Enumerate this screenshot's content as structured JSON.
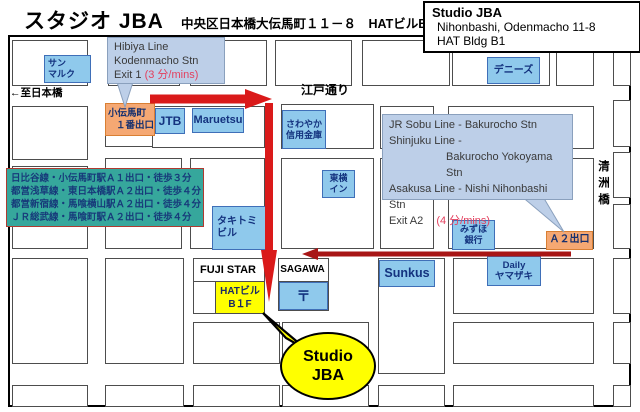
{
  "header": {
    "title": "スタジオ JBA",
    "address": "中央区日本橋大伝馬町１１－８　HATビルB１",
    "info_box": {
      "line1": "Studio JBA",
      "line2": "Nihonbashi, Odenmacho 11-8",
      "line3": "HAT Bldg B1"
    }
  },
  "map": {
    "street_labels": {
      "to_nihonbashi": "←至日本橋",
      "edo_dori": "江戸通り",
      "kiyosubashi": "清洲橋"
    },
    "callouts": {
      "hibiya": {
        "line1": "Hibiya Line",
        "line2": "Kodenmacho Stn",
        "line3_black": "Exit 1",
        "line3_red": "(3 分/mins)"
      },
      "jr": {
        "line1": "JR Sobu Line - Bakurocho Stn",
        "line2": "Shinjuku Line -",
        "line3": "Bakurocho Yokoyama Stn",
        "line4": "Asakusa Line - Nishi Nihonbashi Stn",
        "line5_black": "Exit A2",
        "line5_red": "(4 分/mins)"
      },
      "studio_bubble": {
        "line1": "Studio",
        "line2": "JBA"
      }
    },
    "walking_box": {
      "line1": "日比谷線・小伝馬町駅Ａ１出口・徒歩３分",
      "line2": "都営浅草線・東日本橋駅Ａ２出口・徒歩４分",
      "line3": "都営新宿線・馬喰横山駅Ａ２出口・徒歩４分",
      "line4": "ＪＲ総武線・馬喰町駅Ａ２出口・徒歩４分"
    },
    "landmarks": {
      "sanmaruku": {
        "line1": "サン",
        "line2": "マルク"
      },
      "dennys": "デニーズ",
      "kodenmacho_exit": {
        "line1": "小伝馬町",
        "line2": "１番出口"
      },
      "jtb": "JTB",
      "maruetsu": "Maruetsu",
      "sawayaka": {
        "line1": "さわやか",
        "line2": "信用金庫"
      },
      "toyoko_inn": {
        "line1": "東横",
        "line2": "イン"
      },
      "takitomi": {
        "line1": "タキトミ",
        "line2": "ビル"
      },
      "mizuho": {
        "line1": "みずほ",
        "line2": "銀行"
      },
      "a2_exit": "Ａ２出口",
      "fuji_star": "FUJI STAR",
      "hat_bldg": {
        "line1": "HATビル",
        "line2": "B１F"
      },
      "sagawa": "SAGAWA",
      "post_mark": "〒",
      "sunkus": "Sunkus",
      "daily_yamazaki": {
        "line1": "Daily",
        "line2": "ヤマザキ"
      }
    }
  },
  "colors": {
    "route_red": "#da1a1a",
    "route_dark_red": "#a81616",
    "callout_blue": "#bdcfe8",
    "landmark_blue": "#8fc9ec",
    "exit_orange": "#f5a873",
    "walking_teal": "#36a79c",
    "highlight_yellow": "#ffff00"
  }
}
